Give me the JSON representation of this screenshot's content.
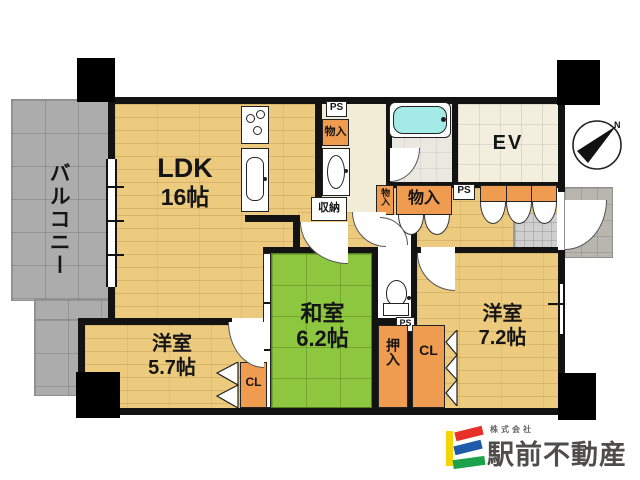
{
  "plan": {
    "balcony_label": "バルコニー",
    "ldk_label": "LDK",
    "ldk_size": "16帖",
    "washitsu_label": "和室",
    "washitsu_size": "6.2帖",
    "bedroom57_label": "洋室",
    "bedroom57_size": "5.7帖",
    "bedroom72_label": "洋室",
    "bedroom72_size": "7.2帖",
    "elevator_label": "EV",
    "ps_top": "PS",
    "ps_entry": "PS",
    "ps_toilet": "PS",
    "closet_kitchen": "物入",
    "closet_hall_small": "物入",
    "closet_hall_large": "物入",
    "shuno_label": "収納",
    "oshiire_label": "押入",
    "cl_57": "CL",
    "cl_72": "CL",
    "compass_north": "N"
  },
  "logo": {
    "prefix": "株式会社",
    "company": "駅前不動産",
    "brand_colors": {
      "yellow": "#f5d503",
      "red": "#e8302a",
      "blue": "#1f5bab",
      "green": "#1ba24a",
      "text": "#4f4c4c"
    }
  },
  "colors": {
    "wood_floor": "#edcb7e",
    "tatami_green": "#8dc63f",
    "balcony_gray": "#acacac",
    "closet_orange": "#ef9b50",
    "washroom_cream": "#f1ecd6",
    "ev_beige": "#f3efdf",
    "bathtub_cyan": "#a4ebe8",
    "wall_black": "#131313"
  }
}
